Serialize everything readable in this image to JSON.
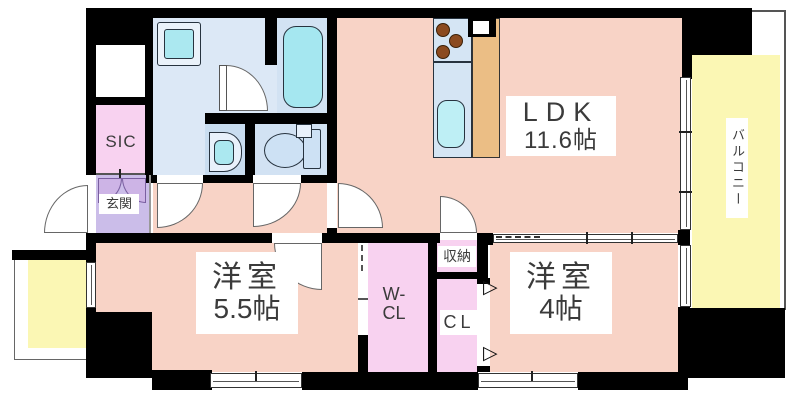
{
  "rooms": {
    "ldk": {
      "label": "LDK",
      "size": "11.6帖"
    },
    "balcony": {
      "label": "バルコニー"
    },
    "western_room_large": {
      "label": "洋室",
      "size": "5.5帖"
    },
    "western_room_small": {
      "label": "洋室",
      "size": "4帖"
    },
    "walk_in_closet": {
      "line1": "W-",
      "line2": "CL"
    },
    "closet": {
      "label": "CL"
    },
    "storage": {
      "label": "収納"
    },
    "entrance": {
      "label": "玄関"
    },
    "shoe_closet": {
      "label": "SIC"
    }
  },
  "markers": {
    "closet_door": "▷"
  },
  "colors": {
    "wall": "#000000",
    "room_floor": "#F8D3C6",
    "closet_floor": "#F8D2F0",
    "entrance_floor": "#CBBDE9",
    "balcony_floor": "#FBF7B4",
    "washroom_floor": "#DCE8F6",
    "bathroom_floor": "#D2E2F3",
    "fixture_teal": "#ABE8F0",
    "counter_wood": "#EBBE85"
  }
}
